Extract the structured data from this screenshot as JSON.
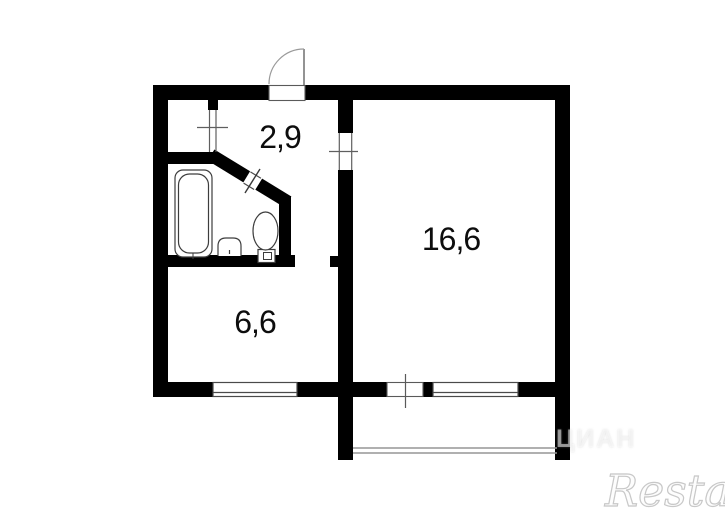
{
  "floorplan": {
    "rooms": [
      {
        "name": "hallway",
        "area_label": "2,9"
      },
      {
        "name": "living-room",
        "area_label": "16,6"
      },
      {
        "name": "kitchen",
        "area_label": "6,6"
      }
    ],
    "fixtures": [
      "bathtub-icon",
      "sink-icon",
      "toilet-icon"
    ],
    "features": [
      "entrance-door-arc",
      "bathroom-diagonal-door",
      "interior-door-openings",
      "kitchen-window",
      "living-room-window",
      "balcony-door",
      "balcony"
    ]
  },
  "watermarks": {
    "brand": "Restate",
    "portal": "ЦИАН"
  },
  "colors": {
    "wall": "#000000",
    "background": "#ffffff",
    "thin_line": "#4a4a4a",
    "door_arc": "#9a9a9a",
    "watermark_stroke": "#c8c8c8"
  }
}
